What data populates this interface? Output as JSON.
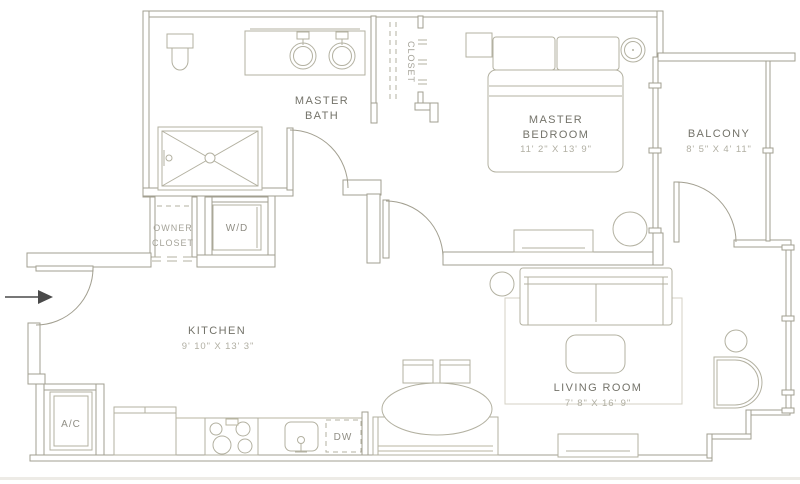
{
  "plan": {
    "title": "One-bedroom apartment floor plan",
    "rooms": {
      "master_bath": {
        "line1": "MASTER",
        "line2": "BATH"
      },
      "closet": {
        "name": "CLOSET"
      },
      "master_bedroom": {
        "line1": "MASTER",
        "line2": "BEDROOM",
        "dims": "11' 2\" X 13' 9\""
      },
      "balcony": {
        "name": "BALCONY",
        "dims": "8' 5\" X 4' 11\""
      },
      "owner_closet": {
        "line1": "OWNER",
        "line2": "CLOSET"
      },
      "washer_dryer": {
        "name": "W/D"
      },
      "kitchen": {
        "name": "KITCHEN",
        "dims": "9' 10\" X 13' 3\""
      },
      "living_room": {
        "name": "LIVING ROOM",
        "dims": "7' 8\" X 16' 9\""
      },
      "ac_closet": {
        "name": "A/C"
      },
      "dishwasher": {
        "name": "DW"
      }
    },
    "colors": {
      "wall": "#a29f90",
      "furniture": "#b3b1a1",
      "room_label": "#74736a",
      "dimension_label": "#b1afa3",
      "small_label": "#908e85",
      "entry_arrow": "#4a4a4a"
    }
  }
}
